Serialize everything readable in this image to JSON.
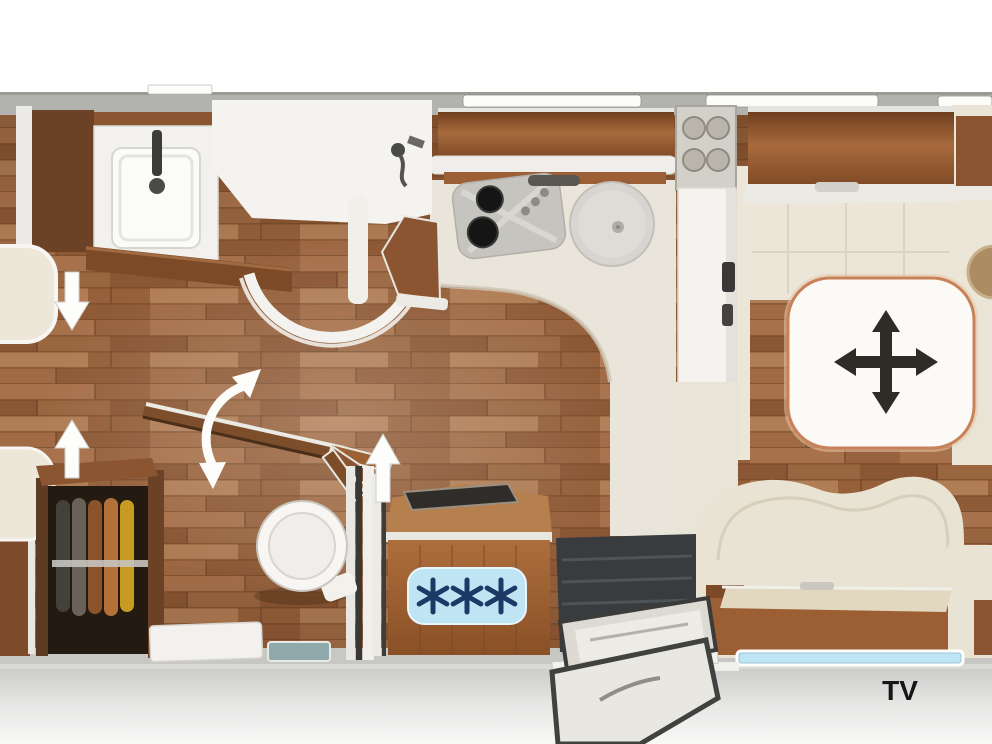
{
  "labels": {
    "tv": "TV"
  },
  "icons": {
    "table_center": "four-way-move-arrow-icon",
    "swivel_wall": "curved-rotation-double-arrow-icon",
    "walkway_upper": "down-arrow-icon",
    "walkway_lower": "up-arrow-icon",
    "beside_fridge": "up-arrow-icon",
    "freezer_badge": "three-snowflakes-icon"
  },
  "colors": {
    "floor_wood": "#9b6843",
    "cabinet_wood": "#8a5530",
    "upholstery_cream": "#ece7d9",
    "wall_gray": "#b2b2ae",
    "window_blue": "#bfe4f4",
    "snowflake_blue": "#1d3a66",
    "table_border": "#c8825a",
    "move_arrow_black": "#2f2c28"
  }
}
